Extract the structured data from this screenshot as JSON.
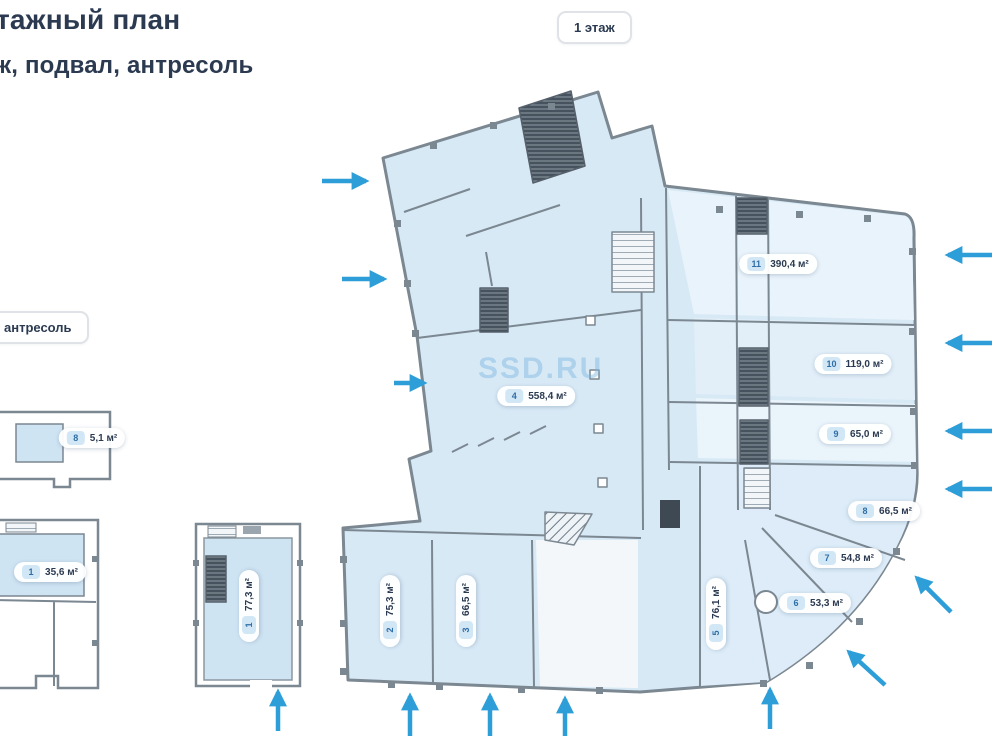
{
  "header": {
    "title": "тажный план",
    "subtitle": "ж, подвал, антресоль",
    "floor_badge": "1 этаж",
    "mezzanine_badge": "антресоль"
  },
  "watermark": "SSD.RU",
  "colors": {
    "arrow_accent": "#2d9ed8",
    "plan_fill": "#d8e9f6",
    "room_fill": "#cfe4f3",
    "wall": "#7b8791",
    "title_text": "#2b3a50"
  },
  "rooms": {
    "r11": {
      "number": "11",
      "area": "390,4 м²"
    },
    "r10": {
      "number": "10",
      "area": "119,0 м²"
    },
    "r9": {
      "number": "9",
      "area": "65,0 м²"
    },
    "r8": {
      "number": "8",
      "area": "66,5 м²"
    },
    "r7": {
      "number": "7",
      "area": "54,8 м²"
    },
    "r6": {
      "number": "6",
      "area": "53,3 м²"
    },
    "r5": {
      "number": "5",
      "area": "76,1 м²"
    },
    "r4": {
      "number": "4",
      "area": "558,4 м²"
    },
    "r3": {
      "number": "3",
      "area": "66,5 м²"
    },
    "r2": {
      "number": "2",
      "area": "75,3 м²"
    },
    "r1_basement": {
      "number": "1",
      "area": "77,3 м²"
    },
    "r1_left": {
      "number": "1",
      "area": "35,6 м²"
    },
    "r8_mezzanine": {
      "number": "8",
      "area": "5,1 м²"
    }
  }
}
